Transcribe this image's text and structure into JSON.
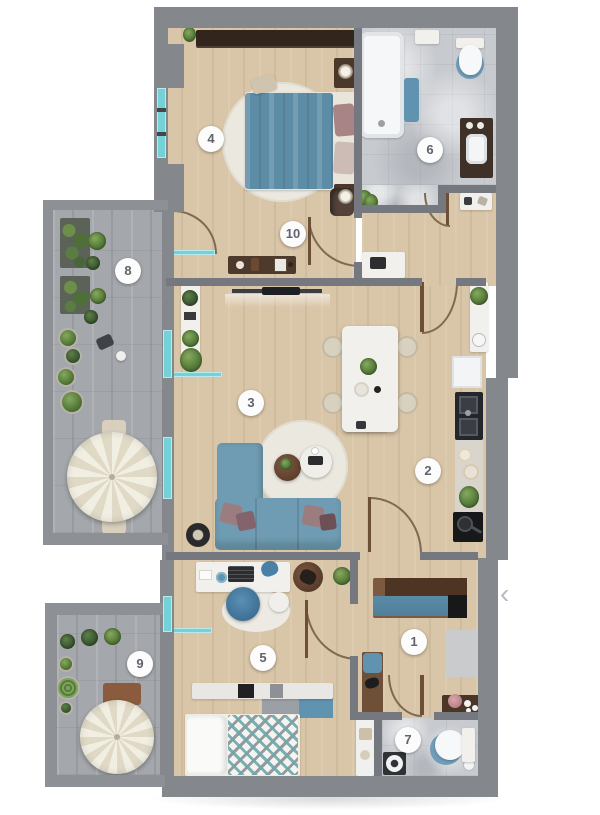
{
  "app": {
    "view": "apartment-floor-plan"
  },
  "carousel": {
    "prev_icon": "‹"
  },
  "floor_plan": {
    "room_markers": [
      {
        "number": "1"
      },
      {
        "number": "2"
      },
      {
        "number": "3"
      },
      {
        "number": "4"
      },
      {
        "number": "5"
      },
      {
        "number": "6"
      },
      {
        "number": "7"
      },
      {
        "number": "8"
      },
      {
        "number": "9"
      },
      {
        "number": "10"
      }
    ],
    "colors": {
      "wall_gray": "#84878c",
      "wood_floor": "#d9c5a7",
      "terrace_tile": "#a4a7ab",
      "bath_marble": "#c7cacf",
      "window_glass": "#74d2d6",
      "furniture_blue": "#6f9cb2",
      "bed_blue": "#5d8ca6",
      "umbrella_cream": "#f1eee2",
      "dark_wardrobe": "#32251b",
      "marker_bg": "#fcfcfc"
    }
  }
}
